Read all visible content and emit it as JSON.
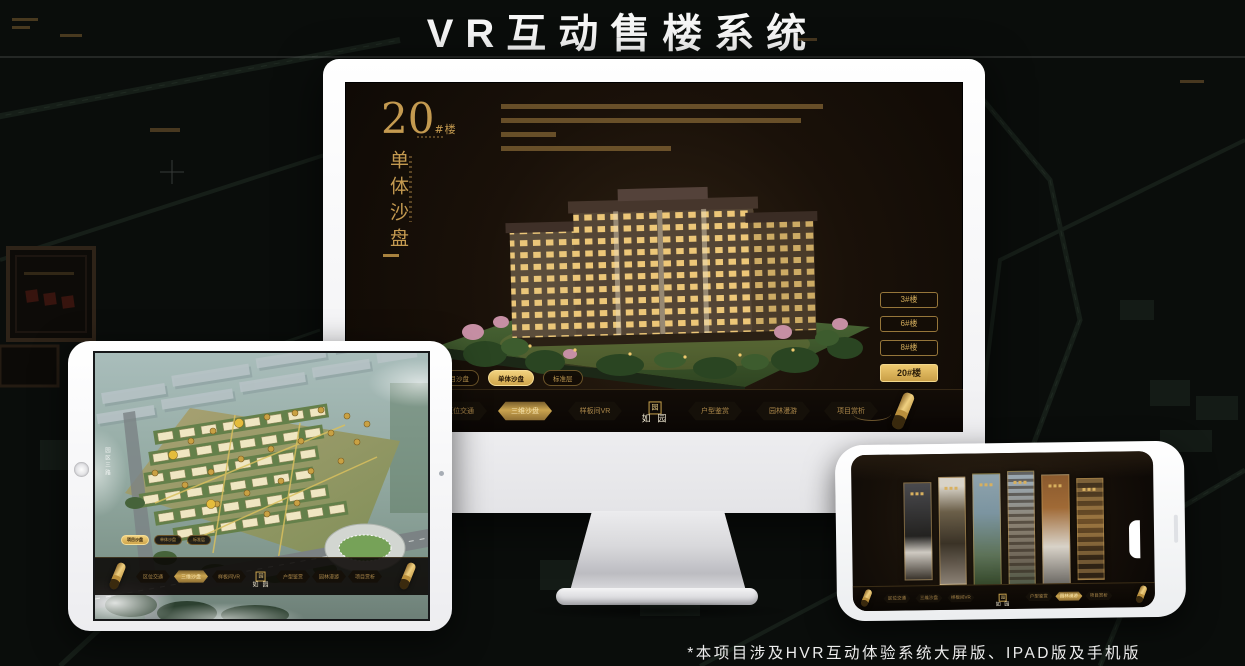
{
  "page": {
    "title": "VR互动售楼系统",
    "footnote": "*本项目涉及HVR互动体验系统大屏版、IPAD版及手机版"
  },
  "colors": {
    "gold": "#c9a158",
    "gold_bright": "#ecc878",
    "screen_bg": "#1b130c",
    "page_bg": "#0a0d0b",
    "title_white": "#f7f7f7"
  },
  "app": {
    "logo": {
      "seal": "园",
      "text": "如 园"
    },
    "nav_items": [
      "区位交通",
      "三维沙盘",
      "样板间VR",
      "户型鉴赏",
      "园林漫游",
      "项目赏析"
    ],
    "sub_tabs": [
      "项目沙盘",
      "单体沙盘",
      "标准层"
    ],
    "building_buttons": [
      "3#楼",
      "6#楼",
      "8#楼",
      "20#楼"
    ]
  },
  "desktop": {
    "headline_number": "20",
    "headline_suffix": "#楼",
    "headline_title": "单体沙盘",
    "active_sub_tab": "单体沙盘",
    "active_nav_item": "三维沙盘",
    "active_building_button": "20#楼"
  },
  "tablet": {
    "road_label": "园区三路",
    "active_sub_tab": "项目沙盘",
    "active_nav_item": "三维沙盘"
  },
  "phone": {
    "active_nav_item": "园林漫游"
  }
}
